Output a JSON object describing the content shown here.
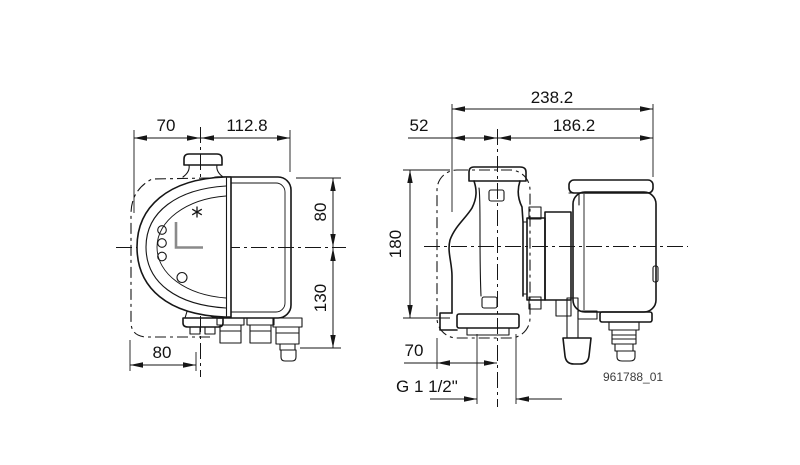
{
  "drawing": {
    "type": "pump dimensional drawing",
    "background_color": "#ffffff",
    "line_color": "#161616",
    "reference_number": "961788_01",
    "views": {
      "front": {
        "name": "front view",
        "dimensions": {
          "top_left": "70",
          "top_right": "112.8",
          "upper_height": "80",
          "lower_height": "130",
          "bottom_width": "80"
        }
      },
      "side": {
        "name": "side view",
        "dimensions": {
          "overall_depth": "238.2",
          "front_depth": "52",
          "rear_depth": "186.2",
          "port_height": "180",
          "base_depth": "70",
          "pipe_connection": "G 1 1/2\""
        }
      }
    }
  }
}
